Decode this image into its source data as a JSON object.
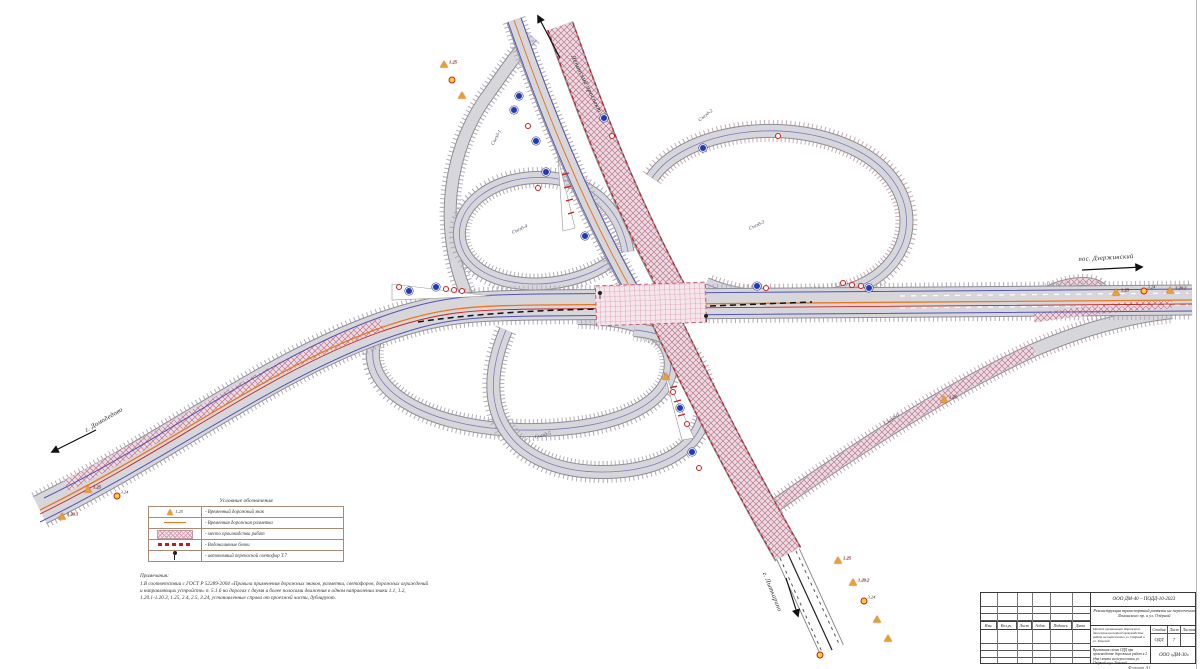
{
  "sheet": {
    "kind": "Схема организации дорожного движения"
  },
  "direction_labels": [
    {
      "text": "Ленинский проспект",
      "x": 586,
      "y": 84,
      "rot": 64
    },
    {
      "text": "пос. Дзержинский",
      "x": 1106,
      "y": 258,
      "rot": -3
    },
    {
      "text": "г. Домодедово",
      "x": 104,
      "y": 420,
      "rot": -30
    },
    {
      "text": "г. Лыткарино",
      "x": 772,
      "y": 592,
      "rot": 68
    }
  ],
  "ramp_labels": [
    {
      "text": "Съезд-1",
      "x": 497,
      "y": 138,
      "rot": -62
    },
    {
      "text": "Съезд-2",
      "x": 706,
      "y": 116,
      "rot": -38
    },
    {
      "text": "Съезд-3",
      "x": 757,
      "y": 226,
      "rot": -25
    },
    {
      "text": "Съезд-4",
      "x": 520,
      "y": 230,
      "rot": -25
    },
    {
      "text": "Съезд-5",
      "x": 543,
      "y": 436,
      "rot": -15
    },
    {
      "text": "Съезд-6",
      "x": 892,
      "y": 420,
      "rot": -33
    }
  ],
  "legend": {
    "title": "Условные обозначения",
    "rows": [
      {
        "symbol": "temporary-road-sign",
        "code": "1.25",
        "label": "- Временный дорожный знак"
      },
      {
        "symbol": "temporary-road-marking",
        "label": "- Временная дорожная разметка"
      },
      {
        "symbol": "work-zone-hatch",
        "label": "- место производства работ"
      },
      {
        "symbol": "water-filled-blocks",
        "label": "- Водоналивные блоки"
      },
      {
        "symbol": "portable-traffic-light",
        "label": "- автономный переносной светофор Т.7"
      }
    ]
  },
  "notes": {
    "title": "Примечания:",
    "line1": "1.В соответствии с ГОСТ Р 52289-2004 «Правила применения дорожных знаков, разметки, светофоров, дорожных ограждений",
    "line2": "и направляющих устройств» п. 5.1.6 на дорогах с двумя и более полосами движения в одном направлении знаки 1.1, 1.2,",
    "line3": "1.20.1-1.20.3, 1.25, 2.4, 2.5, 3.24, установленные справа от проезжей части, дублируют."
  },
  "title_block": {
    "doc_number": "ООО ДМ-40 – ПОДД-10-2023",
    "project": "Реконструкция транспортной развязки на пересечении Ленинского пр. и ул. Озёрной",
    "header_row": [
      "Изм.",
      "Кол.уч.",
      "Лист",
      "№док.",
      "Подпись",
      "Дата"
    ],
    "object_text": "Проект организации дорожного движения на период производства работ на пересечении ул. Озёрной и ул. Томской",
    "stage_label": "Стадия",
    "sheet_label": "Лист",
    "sheets_label": "Листов",
    "stage": "ОДД",
    "sheet": "7",
    "sheets": "",
    "drawing_title": "Временная схема ОДД при производстве дорожных работ в 2 (два) этапа на пересечении ул. Озёрной и ул. Томской",
    "company": "ООО «ДМ-30»",
    "format_note": "Формат А1"
  },
  "signs": [
    {
      "x": 444,
      "y": 64,
      "kind": "tri",
      "code": "1.25"
    },
    {
      "x": 452,
      "y": 80,
      "kind": "yellow"
    },
    {
      "x": 462,
      "y": 95,
      "kind": "tri"
    },
    {
      "x": 519,
      "y": 96,
      "kind": "blue"
    },
    {
      "x": 514,
      "y": 110,
      "kind": "blue"
    },
    {
      "x": 528,
      "y": 126,
      "kind": "red"
    },
    {
      "x": 536,
      "y": 141,
      "kind": "blue"
    },
    {
      "x": 604,
      "y": 118,
      "kind": "blue"
    },
    {
      "x": 612,
      "y": 136,
      "kind": "red"
    },
    {
      "x": 703,
      "y": 148,
      "kind": "blue"
    },
    {
      "x": 778,
      "y": 136,
      "kind": "red"
    },
    {
      "x": 546,
      "y": 172,
      "kind": "blue"
    },
    {
      "x": 538,
      "y": 188,
      "kind": "red"
    },
    {
      "x": 585,
      "y": 236,
      "kind": "blue"
    },
    {
      "x": 399,
      "y": 287,
      "kind": "red"
    },
    {
      "x": 409,
      "y": 291,
      "kind": "blue"
    },
    {
      "x": 436,
      "y": 287,
      "kind": "blue"
    },
    {
      "x": 446,
      "y": 289,
      "kind": "red"
    },
    {
      "x": 454,
      "y": 290,
      "kind": "red"
    },
    {
      "x": 462,
      "y": 291,
      "kind": "red"
    },
    {
      "x": 757,
      "y": 286,
      "kind": "blue"
    },
    {
      "x": 766,
      "y": 288,
      "kind": "red"
    },
    {
      "x": 843,
      "y": 283,
      "kind": "red"
    },
    {
      "x": 852,
      "y": 285,
      "kind": "red"
    },
    {
      "x": 861,
      "y": 286,
      "kind": "red"
    },
    {
      "x": 869,
      "y": 288,
      "kind": "blue"
    },
    {
      "x": 666,
      "y": 376,
      "kind": "tri"
    },
    {
      "x": 673,
      "y": 392,
      "kind": "red"
    },
    {
      "x": 680,
      "y": 408,
      "kind": "blue"
    },
    {
      "x": 687,
      "y": 424,
      "kind": "red"
    },
    {
      "x": 692,
      "y": 452,
      "kind": "blue"
    },
    {
      "x": 699,
      "y": 468,
      "kind": "red"
    },
    {
      "x": 1116,
      "y": 292,
      "kind": "tri",
      "code": "1.25"
    },
    {
      "x": 1144,
      "y": 291,
      "kind": "yellow",
      "code": "3.24"
    },
    {
      "x": 1170,
      "y": 290,
      "kind": "tri",
      "code": "1.20.2"
    },
    {
      "x": 88,
      "y": 489,
      "kind": "tri",
      "code": "1.25"
    },
    {
      "x": 117,
      "y": 496,
      "kind": "yellow",
      "code": "3.24"
    },
    {
      "x": 62,
      "y": 516,
      "kind": "tri",
      "code": "1.20.1"
    },
    {
      "x": 944,
      "y": 399,
      "kind": "tri",
      "code": "1.25"
    },
    {
      "x": 838,
      "y": 560,
      "kind": "tri",
      "code": "1.25"
    },
    {
      "x": 853,
      "y": 582,
      "kind": "tri",
      "code": "1.20.2"
    },
    {
      "x": 864,
      "y": 601,
      "kind": "yellow",
      "code": "3.24"
    },
    {
      "x": 877,
      "y": 619,
      "kind": "tri"
    },
    {
      "x": 888,
      "y": 638,
      "kind": "tri"
    },
    {
      "x": 820,
      "y": 655,
      "kind": "yellow"
    }
  ]
}
